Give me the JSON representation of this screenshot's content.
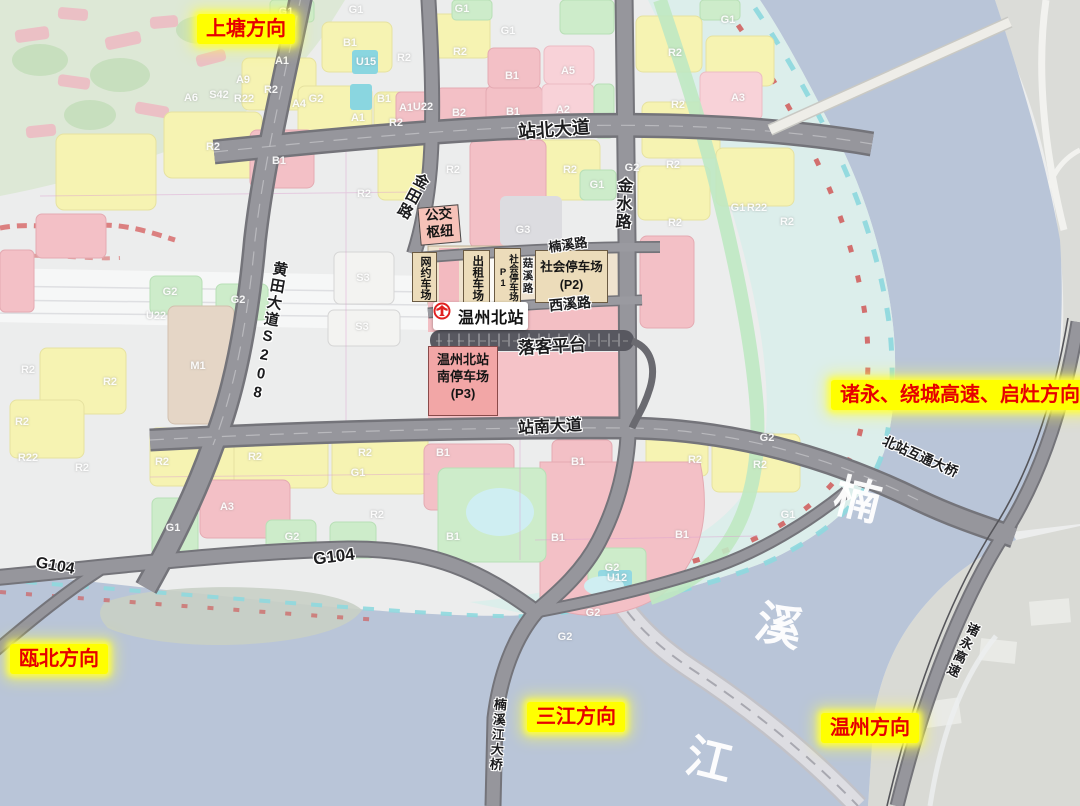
{
  "map_title": "温州北站",
  "colors": {
    "highlight_bg": "#ffff00",
    "highlight_text": "#e60000",
    "water": "#b9c5d8",
    "floodplain": "#d9edea",
    "residential_yellow": "#f6f3b2",
    "commercial_pink": "#f3c0c6",
    "green_space": "#cdecca",
    "road_gray": "#96969c",
    "parking_tan": "#ecdcba",
    "station_red": "#e02020"
  },
  "direction_labels": [
    {
      "text": "上塘方向",
      "x": 197,
      "y": 14
    },
    {
      "text": "诸永、绕城高速、启灶方向",
      "x": 831,
      "y": 380
    },
    {
      "text": "瓯北方向",
      "x": 10,
      "y": 644
    },
    {
      "text": "三江方向",
      "x": 527,
      "y": 702
    },
    {
      "text": "温州方向",
      "x": 821,
      "y": 713
    }
  ],
  "road_labels": [
    {
      "text": "站北大道",
      "x": 554,
      "y": 130,
      "rot": -4,
      "size": 18
    },
    {
      "text": "金田路",
      "x": 412,
      "y": 196,
      "rot": 28,
      "size": 15,
      "vertical": true
    },
    {
      "text": "金水路",
      "x": 621,
      "y": 204,
      "rot": 3,
      "size": 16,
      "vertical": true
    },
    {
      "text": "楠溪路",
      "x": 568,
      "y": 245,
      "rot": -8,
      "size": 13
    },
    {
      "text": "菇溪路",
      "x": 527,
      "y": 276,
      "rot": 0,
      "size": 10.5,
      "vertical": true
    },
    {
      "text": "西溪路",
      "x": 570,
      "y": 304,
      "rot": -5,
      "size": 14
    },
    {
      "text": "站南大道",
      "x": 550,
      "y": 428,
      "rot": -3,
      "size": 16
    },
    {
      "text": "黄田大道S208",
      "x": 268,
      "y": 332,
      "rot": 10,
      "size": 15,
      "vertical": true
    },
    {
      "text": "G104",
      "x": 55,
      "y": 567,
      "rot": 10,
      "size": 16
    },
    {
      "text": "G104",
      "x": 334,
      "y": 557,
      "rot": -7,
      "size": 17
    },
    {
      "text": "北站互通大桥",
      "x": 920,
      "y": 457,
      "rot": 24,
      "size": 13.5
    },
    {
      "text": "诸永高速",
      "x": 962,
      "y": 650,
      "rot": 25,
      "size": 13,
      "vertical": true
    },
    {
      "text": "楠溪江大桥",
      "x": 497,
      "y": 735,
      "rot": 4,
      "size": 13,
      "vertical": true
    }
  ],
  "facilities": {
    "bus_hub": "公交\n枢纽",
    "ride_hail": "网约车场",
    "taxi": "出租车场",
    "p1": "社会停车场P1",
    "p2": "社会停车场\n(P2)",
    "station": "温州北站",
    "dropoff": "落客平台",
    "p3": "温州北站\n南停车场\n(P3)"
  },
  "river_name": [
    {
      "char": "楠",
      "x": 858,
      "y": 497
    },
    {
      "char": "溪",
      "x": 780,
      "y": 623
    },
    {
      "char": "江",
      "x": 710,
      "y": 757
    }
  ],
  "block_labels": [
    {
      "t": "G1",
      "x": 286,
      "y": 12
    },
    {
      "t": "G1",
      "x": 356,
      "y": 10
    },
    {
      "t": "G1",
      "x": 462,
      "y": 9
    },
    {
      "t": "G1",
      "x": 508,
      "y": 31
    },
    {
      "t": "B1",
      "x": 350,
      "y": 43
    },
    {
      "t": "U15",
      "x": 366,
      "y": 62
    },
    {
      "t": "R2",
      "x": 404,
      "y": 58
    },
    {
      "t": "R2",
      "x": 460,
      "y": 52
    },
    {
      "t": "A1",
      "x": 282,
      "y": 61
    },
    {
      "t": "A9",
      "x": 243,
      "y": 80
    },
    {
      "t": "A6",
      "x": 191,
      "y": 98
    },
    {
      "t": "S42",
      "x": 219,
      "y": 95
    },
    {
      "t": "R22",
      "x": 244,
      "y": 99
    },
    {
      "t": "R2",
      "x": 271,
      "y": 90
    },
    {
      "t": "G2",
      "x": 316,
      "y": 99
    },
    {
      "t": "A4",
      "x": 299,
      "y": 104
    },
    {
      "t": "A1",
      "x": 358,
      "y": 118
    },
    {
      "t": "B1",
      "x": 384,
      "y": 99
    },
    {
      "t": "R2",
      "x": 396,
      "y": 123
    },
    {
      "t": "U22",
      "x": 423,
      "y": 107
    },
    {
      "t": "A1",
      "x": 406,
      "y": 108
    },
    {
      "t": "B2",
      "x": 459,
      "y": 113
    },
    {
      "t": "B1",
      "x": 513,
      "y": 112
    },
    {
      "t": "A2",
      "x": 563,
      "y": 110
    },
    {
      "t": "A5",
      "x": 568,
      "y": 71
    },
    {
      "t": "B1",
      "x": 512,
      "y": 76
    },
    {
      "t": "R2",
      "x": 213,
      "y": 147
    },
    {
      "t": "B1",
      "x": 279,
      "y": 161
    },
    {
      "t": "R2",
      "x": 364,
      "y": 194
    },
    {
      "t": "R2",
      "x": 453,
      "y": 170
    },
    {
      "t": "R2",
      "x": 570,
      "y": 170
    },
    {
      "t": "G1",
      "x": 597,
      "y": 185
    },
    {
      "t": "G2",
      "x": 632,
      "y": 168
    },
    {
      "t": "R2",
      "x": 673,
      "y": 165
    },
    {
      "t": "R2",
      "x": 675,
      "y": 223
    },
    {
      "t": "G3",
      "x": 523,
      "y": 230
    },
    {
      "t": "R2",
      "x": 675,
      "y": 53
    },
    {
      "t": "R2",
      "x": 678,
      "y": 105
    },
    {
      "t": "A3",
      "x": 738,
      "y": 98
    },
    {
      "t": "G1",
      "x": 728,
      "y": 20
    },
    {
      "t": "G1",
      "x": 738,
      "y": 208
    },
    {
      "t": "R22",
      "x": 757,
      "y": 208
    },
    {
      "t": "R2",
      "x": 787,
      "y": 222
    },
    {
      "t": "G2",
      "x": 170,
      "y": 292
    },
    {
      "t": "G2",
      "x": 238,
      "y": 300
    },
    {
      "t": "U22",
      "x": 156,
      "y": 316
    },
    {
      "t": "M1",
      "x": 198,
      "y": 366
    },
    {
      "t": "S3",
      "x": 363,
      "y": 278
    },
    {
      "t": "S3",
      "x": 362,
      "y": 327
    },
    {
      "t": "R2",
      "x": 28,
      "y": 370
    },
    {
      "t": "R2",
      "x": 110,
      "y": 382
    },
    {
      "t": "R2",
      "x": 22,
      "y": 422
    },
    {
      "t": "R22",
      "x": 28,
      "y": 458
    },
    {
      "t": "R2",
      "x": 82,
      "y": 468
    },
    {
      "t": "R2",
      "x": 162,
      "y": 462
    },
    {
      "t": "A3",
      "x": 227,
      "y": 507
    },
    {
      "t": "G1",
      "x": 173,
      "y": 528
    },
    {
      "t": "R2",
      "x": 255,
      "y": 457
    },
    {
      "t": "R2",
      "x": 365,
      "y": 453
    },
    {
      "t": "G1",
      "x": 358,
      "y": 473
    },
    {
      "t": "R2",
      "x": 377,
      "y": 515
    },
    {
      "t": "G2",
      "x": 292,
      "y": 537
    },
    {
      "t": "B1",
      "x": 443,
      "y": 453
    },
    {
      "t": "B1",
      "x": 453,
      "y": 537
    },
    {
      "t": "B1",
      "x": 578,
      "y": 462
    },
    {
      "t": "R2",
      "x": 695,
      "y": 460
    },
    {
      "t": "R2",
      "x": 760,
      "y": 465
    },
    {
      "t": "B1",
      "x": 558,
      "y": 538
    },
    {
      "t": "B1",
      "x": 682,
      "y": 535
    },
    {
      "t": "G2",
      "x": 612,
      "y": 568
    },
    {
      "t": "U12",
      "x": 617,
      "y": 578
    },
    {
      "t": "G2",
      "x": 593,
      "y": 613
    },
    {
      "t": "G2",
      "x": 767,
      "y": 438
    },
    {
      "t": "G1",
      "x": 788,
      "y": 515
    },
    {
      "t": "G2",
      "x": 565,
      "y": 637
    }
  ]
}
